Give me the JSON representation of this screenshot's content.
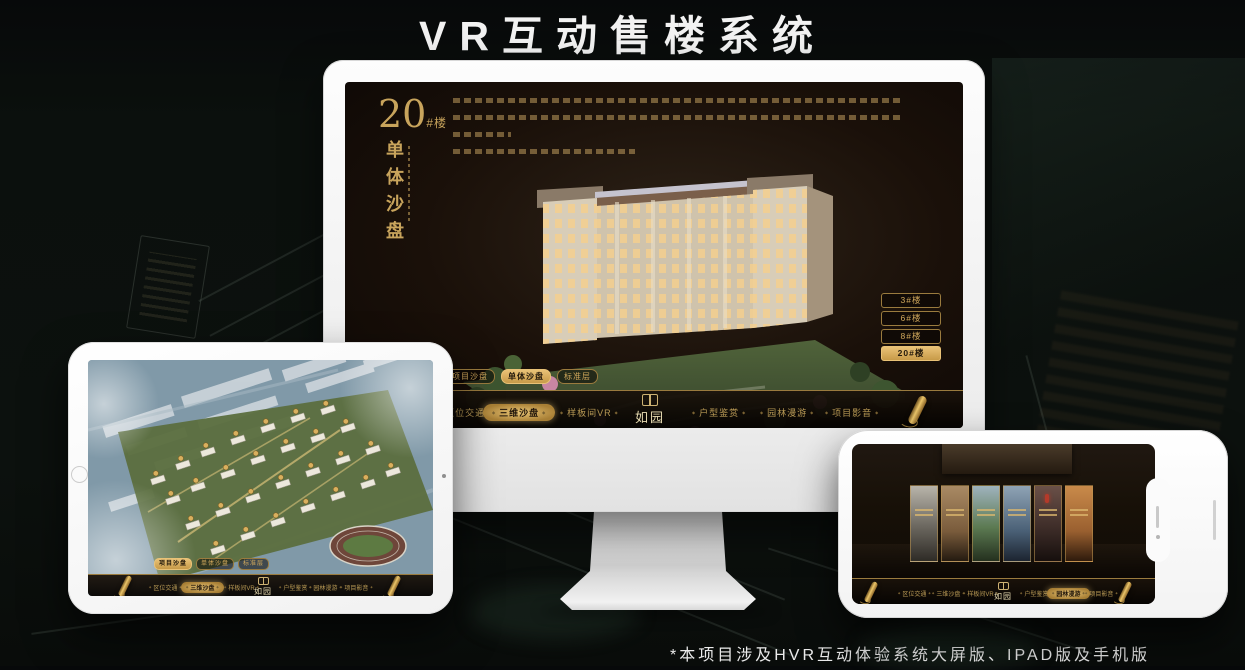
{
  "title": "VR互动售楼系统",
  "footnote": "*本项目涉及HVR互动体验系统大屏版、IPAD版及手机版",
  "colors": {
    "gold": "#d2a95c",
    "gold_active_bg": "#d9ae5e",
    "active_text": "#241a0c",
    "title_text": "#f2f2f2",
    "screen_bg": "#1a1009"
  },
  "desktop": {
    "building_no": "20",
    "building_no_suffix": "#楼",
    "panel_title": "单体沙盘",
    "floor_buttons": [
      {
        "label": "3#楼",
        "active": false
      },
      {
        "label": "6#楼",
        "active": false
      },
      {
        "label": "8#楼",
        "active": false
      },
      {
        "label": "20#楼",
        "active": true
      }
    ],
    "sub_tabs": [
      {
        "label": "项目沙盘",
        "active": false
      },
      {
        "label": "单体沙盘",
        "active": true
      },
      {
        "label": "标准层",
        "active": false
      }
    ],
    "nav": {
      "logo": "如园",
      "items": [
        {
          "label": "区位交通",
          "active": false
        },
        {
          "label": "三维沙盘",
          "active": true
        },
        {
          "label": "样板间VR",
          "active": false
        },
        {
          "label": "户型鉴赏",
          "active": false
        },
        {
          "label": "园林漫游",
          "active": false
        },
        {
          "label": "项目影音",
          "active": false
        }
      ]
    }
  },
  "tablet": {
    "sub_tabs": [
      {
        "label": "项目沙盘",
        "active": true
      },
      {
        "label": "单体沙盘",
        "active": false
      },
      {
        "label": "标准层",
        "active": false
      }
    ],
    "nav": {
      "logo": "如园",
      "items": [
        {
          "label": "区位交通",
          "active": false
        },
        {
          "label": "三维沙盘",
          "active": true
        },
        {
          "label": "样板间VR",
          "active": false
        },
        {
          "label": "户型鉴赏",
          "active": false
        },
        {
          "label": "园林漫游",
          "active": false
        },
        {
          "label": "项目影音",
          "active": false
        }
      ]
    }
  },
  "phone": {
    "nav": {
      "logo": "如园",
      "items": [
        {
          "label": "区位交通",
          "active": false
        },
        {
          "label": "三维沙盘",
          "active": false
        },
        {
          "label": "样板间VR",
          "active": false
        },
        {
          "label": "户型鉴赏",
          "active": false
        },
        {
          "label": "园林漫游",
          "active": true
        },
        {
          "label": "项目影音",
          "active": false
        }
      ]
    }
  }
}
